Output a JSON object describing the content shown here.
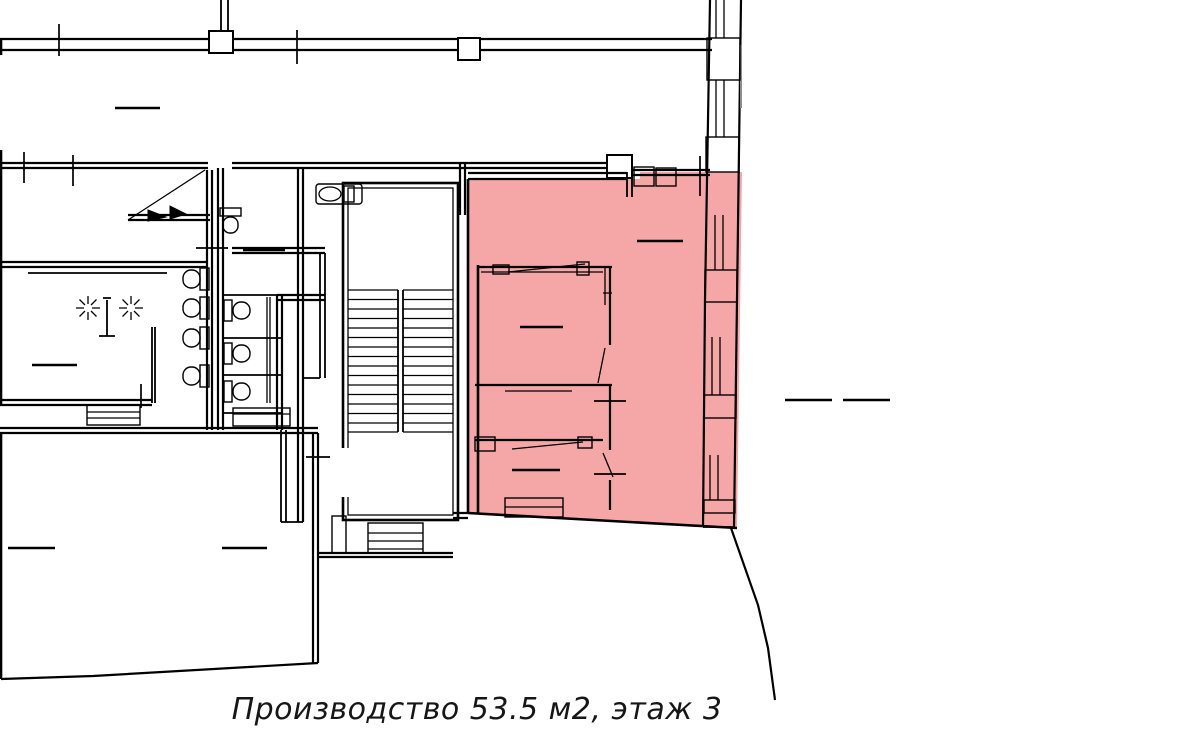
{
  "caption": {
    "text": "Производство 53.5 м2, этаж 3"
  },
  "highlight": {
    "room_label": "Производство",
    "area_m2": "53.5",
    "floor": "3",
    "fill_color": "#f5a6a6",
    "region_points": "468,179 640,179 640,172 742,172 737,528 468,513"
  },
  "plan": {
    "wall_color": "#000000",
    "window_wall_side": "right",
    "features": [
      "exterior walls",
      "window piers",
      "double-flight staircase",
      "wc toilets",
      "sinks",
      "door swings",
      "dimension dashes",
      "highlighted production room"
    ]
  }
}
